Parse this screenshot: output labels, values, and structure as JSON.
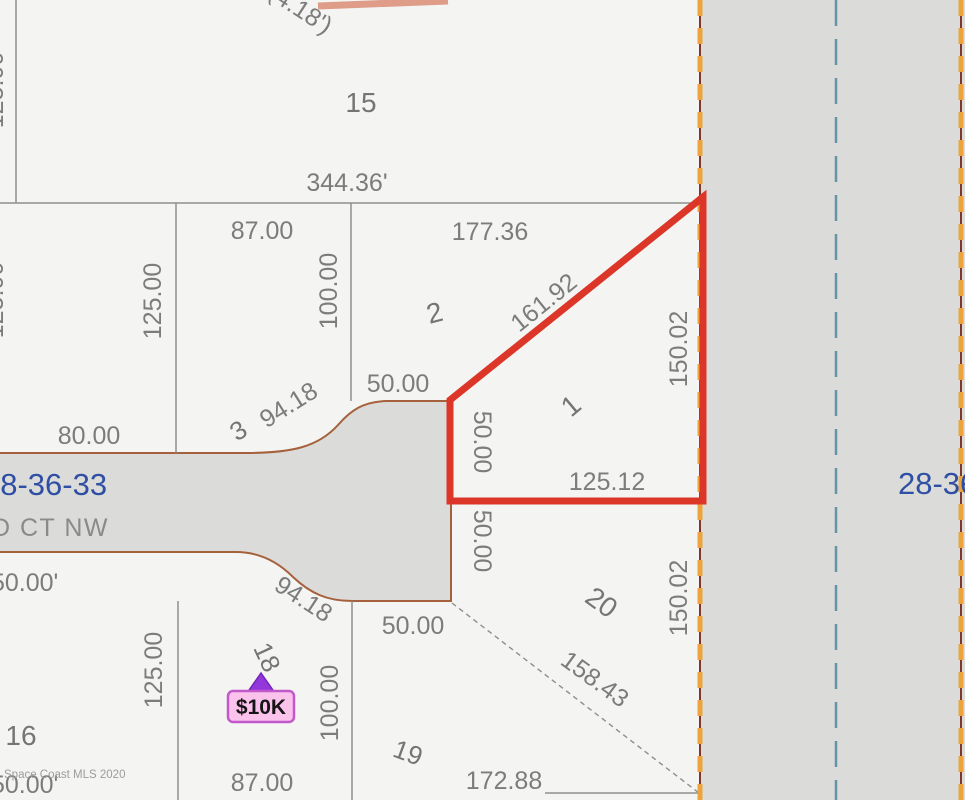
{
  "map": {
    "section_label_left": "28-36-33",
    "section_label_right": "28-36-33",
    "street_name": "D CT NW",
    "watermark": "Space Coast MLS 2020",
    "price_marker": {
      "label": "$10K"
    },
    "lots": {
      "lot1": "1",
      "lot2": "2",
      "lot3": "3",
      "lot15": "15",
      "lot16": "16",
      "lot18": "18",
      "lot19": "19",
      "lot20": "20"
    },
    "dimensions": {
      "dim_4_18": "(4.18')",
      "dim_344_36": "344.36'",
      "dim_87_top": "87.00",
      "dim_177_36": "177.36",
      "dim_100_top": "100.00",
      "dim_125_left_top": "125.00",
      "dim_125_left_mid": "125.00",
      "dim_125_mid": "125.00",
      "dim_161_92": "161.92",
      "dim_50_top": "50.00",
      "dim_94_18_top": "94.18",
      "dim_80": "80.00",
      "dim_50ft_left": "50.00'",
      "dim_50_v_top": "50.00",
      "dim_150_02_top": "150.02",
      "dim_125_12": "125.12",
      "dim_50_v_bot": "50.00",
      "dim_150_02_bot": "150.02",
      "dim_94_18_bot": "94.18",
      "dim_50_bot": "50.00",
      "dim_158_43": "158.43",
      "dim_100_bot": "100.00",
      "dim_125_bot": "125.00",
      "dim_87_bot": "87.00",
      "dim_172_88": "172.88",
      "dim_50ft_bot": "50.00'"
    },
    "colors": {
      "highlight_red": "#DC3628",
      "road_fill": "#DBDBDA",
      "boundary_orange_dash": "#EDA43C",
      "boundary_blue_dash": "#6494A6",
      "section_text_blue": "#2E4FA3",
      "price_pink": "#FBC2EC",
      "marker_purple": "#9137DB"
    }
  }
}
